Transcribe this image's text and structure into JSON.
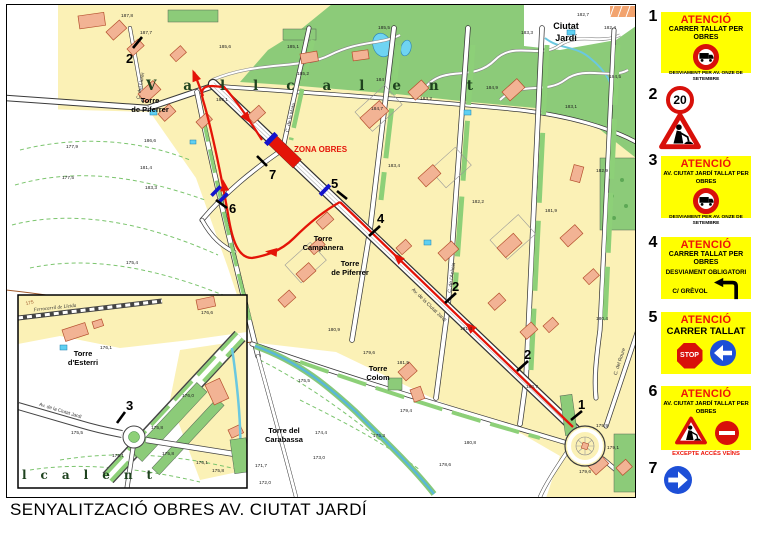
{
  "title": "SENYALITZACIÓ OBRES AV. CIUTAT JARDÍ",
  "colors": {
    "sign_yellow": "#ffff00",
    "attention_red": "#ee1408",
    "route_red": "#e41408",
    "marker_blue": "#1414cc",
    "block_yellow": "#fbf1b6",
    "building_salmon": "#f2b394",
    "park_green": "#8ccb79",
    "water_blue": "#6fd4f2"
  },
  "map": {
    "region_labels": {
      "vallcalent": "Vallcalent",
      "vallcalent_inset": "lcalent",
      "ciutat_jardi_line1": "Ciutat",
      "ciutat_jardi_line2": "Jardí"
    },
    "zona_obres_label": "ZONA OBRES",
    "places": {
      "torre_piferrer_nw_1": "Torre",
      "torre_piferrer_nw_2": "de Piferrer",
      "torre_campanera_1": "Torre",
      "torre_campanera_2": "Campanera",
      "torre_piferrer_c_1": "Torre",
      "torre_piferrer_c_2": "de Piferrer",
      "torre_colom_1": "Torre",
      "torre_colom_2": "Colom",
      "torre_carabassa_1": "Torre del",
      "torre_carabassa_2": "Carabassa",
      "torre_esterri_1": "Torre",
      "torre_esterri_2": "d'Esterri"
    },
    "streets": {
      "av_ciutat_jardi": "Av. de la Ciutat Jardí",
      "av_ciutat_jardi_inset": "Av. de la Ciutat Jardí",
      "c_del_llorer": "C. del Llorer",
      "c_de_la_mata": "C. de la Mata",
      "c_de_lacacia": "C. de l'Acàcia",
      "c_del_roure": "C. del Roure",
      "ferrocarril": "Ferrocarril de Lleida"
    },
    "route_markers": {
      "m1": "1",
      "m2a": "2",
      "m2b": "2",
      "m2c": "2",
      "m3": "3",
      "m4": "4",
      "m5": "5",
      "m6": "6",
      "m7": "7"
    },
    "elevations": [
      "187,8",
      "187,7",
      "186,1",
      "185,6",
      "186,6",
      "185,2",
      "185,1",
      "184",
      "183,2",
      "184,7",
      "183,3",
      "184,9",
      "182,7",
      "182,4",
      "184,5",
      "183,1",
      "183,3",
      "181,4",
      "181,4",
      "177,9",
      "177,5",
      "175,4",
      "183,4",
      "182,2",
      "181,9",
      "182,9",
      "180,9",
      "181,5",
      "179,6",
      "179,4",
      "175,5",
      "175,3",
      "174,4",
      "173,0",
      "171,7",
      "172,0",
      "180,4",
      "180,7",
      "179,9",
      "179,1",
      "179,6",
      "180,8",
      "178,6",
      "176,1",
      "175,8",
      "175,5",
      "175,1",
      "175,8",
      "176,1",
      "175,8",
      "176,0",
      "176,6",
      "175",
      "185,5"
    ]
  },
  "legend": {
    "items": [
      {
        "num": "1",
        "title": "ATENCIÓ",
        "line1": "CARRER TALLAT PER OBRES",
        "icon": "no-trucks-prohibition",
        "footer": "DESVIAMENT PER AV. ONZE DE SETEMBRE"
      },
      {
        "num": "2",
        "speed": "20",
        "icon": "roadworks-triangle"
      },
      {
        "num": "3",
        "title": "ATENCIÓ",
        "line1": "AV. CIUTAT JARDÍ TALLAT PER OBRES",
        "icon": "no-trucks-prohibition",
        "footer": "DESVIAMENT PER AV. ONZE DE SETEMBRE"
      },
      {
        "num": "4",
        "title": "ATENCIÓ",
        "line1": "CARRER TALLAT PER OBRES",
        "line2": "DESVIAMENT OBLIGATORI",
        "line3": "C/ GRÈVOL",
        "icon": "turn-left-arrow"
      },
      {
        "num": "5",
        "title": "ATENCIÓ",
        "line1": "CARRER TALLAT",
        "stop": "STOP",
        "icon": "blue-left-arrow"
      },
      {
        "num": "6",
        "title": "ATENCIÓ",
        "line1": "AV. CIUTAT JARDÍ TALLAT PER OBRES",
        "icons": "roadworks-triangle,no-entry",
        "footer": "EXCEPTE ACCÉS VEÏNS"
      },
      {
        "num": "7",
        "icon": "blue-right-arrow"
      }
    ]
  }
}
